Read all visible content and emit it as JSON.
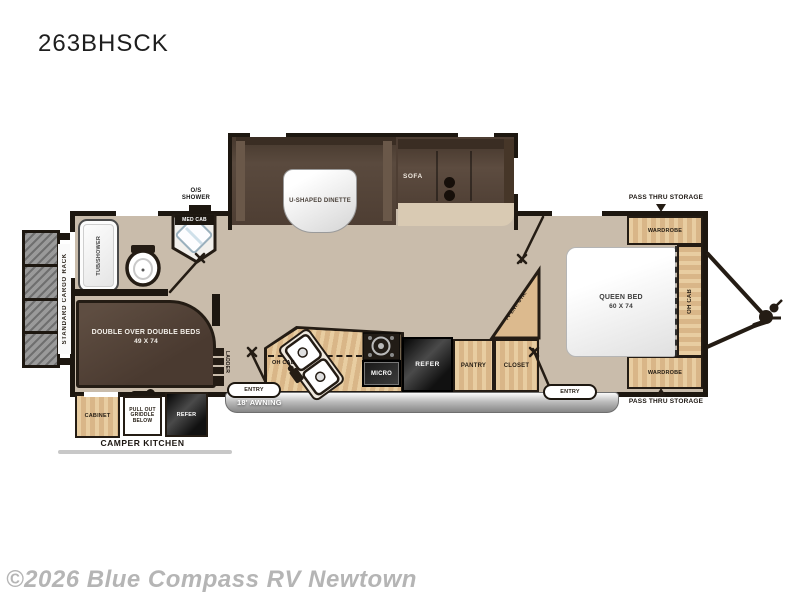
{
  "page": {
    "title": "263BHSCK",
    "watermark": "©2026 Blue Compass RV Newtown"
  },
  "floorplan": {
    "exterior": {
      "cargo_rack": "STANDARD CARGO RACK",
      "awning": "18' AWNING",
      "entry_doors": [
        "ENTRY",
        "ENTRY"
      ],
      "pass_thru_storage_top": "PASS THRU STORAGE",
      "pass_thru_storage_bottom": "PASS THRU STORAGE"
    },
    "living_area": {
      "dinette": "U-SHAPED DINETTE",
      "sofa": "SOFA"
    },
    "bathroom": {
      "outside_shower_line1": "O/S",
      "outside_shower_line2": "SHOWER",
      "med_cab": "MED CAB",
      "tub_shower": "TUB/SHOWER"
    },
    "bunk_room": {
      "bed_line1": "DOUBLE OVER DOUBLE BEDS",
      "bed_line2": "49 X 74",
      "ladder": "LADDER"
    },
    "kitchen": {
      "overhead_cabinet": "OH CAB",
      "microwave": "MICRO",
      "refrigerator": "REFER",
      "pantry": "PANTRY",
      "closet": "CLOSET",
      "tv_center": "TV ENT. CTR."
    },
    "bedroom": {
      "bed_line1": "QUEEN BED",
      "bed_line2": "60 X 74",
      "wardrobe_top": "WARDROBE",
      "wardrobe_bottom": "WARDROBE",
      "overhead_cabinet": "OH CAB"
    },
    "camper_kitchen": {
      "label": "CAMPER KITCHEN",
      "cabinet": "CABINET",
      "griddle_line1": "PULL OUT",
      "griddle_line2": "GRIDDLE",
      "griddle_line3": "BELOW",
      "refrigerator": "REFER"
    }
  },
  "colors": {
    "floor": "#c9bcab",
    "wall": "#1d1710",
    "wood_cabinet": "#ddbb8f",
    "dark_furniture": "#54443a",
    "appliance_black": "#1e1e1e",
    "awning_gray": "#9b9b9b",
    "watermark_gray": "#b5b5b5",
    "background": "#ffffff"
  }
}
